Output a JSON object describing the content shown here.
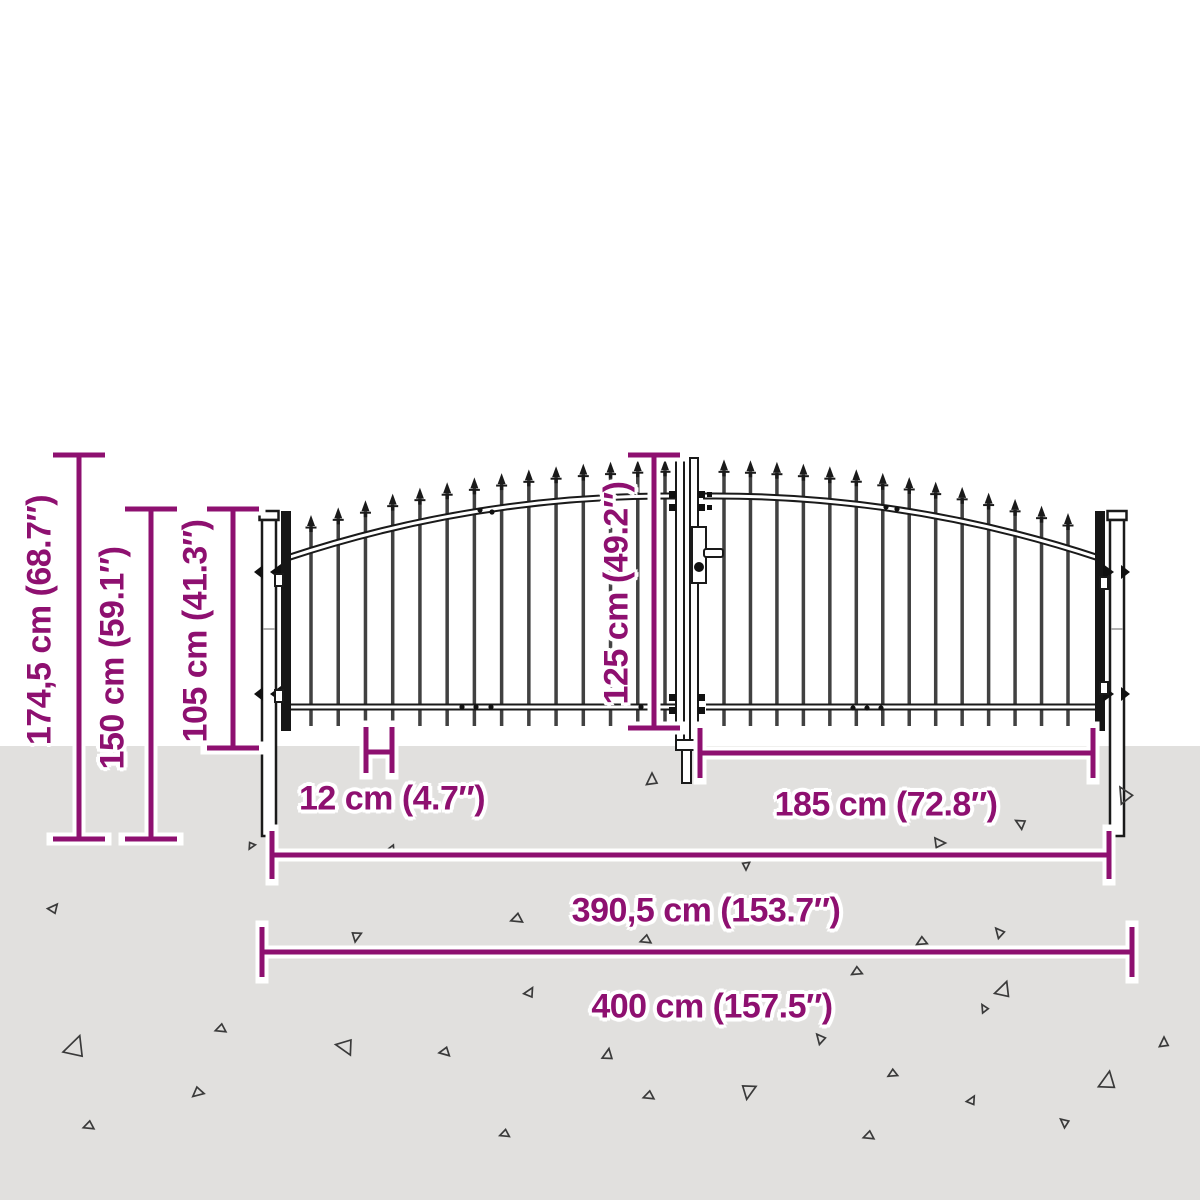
{
  "title": "Double door garden gate with spear top - dimension diagram",
  "colors": {
    "annotation": "#8E1070",
    "halo": "#ffffff",
    "gate": "#1a1a1a",
    "bar": "#414141",
    "ground": "#e1e0de",
    "background": "#ffffff",
    "triangle": "#3a3a3a"
  },
  "labels": {
    "total_height": "174,5 cm (68.7″)",
    "height_150": "150 cm (59.1″)",
    "height_105": "105 cm (41.3″)",
    "height_125": "125 cm (49.2″)",
    "spacing_12": "12 cm (4.7″)",
    "width_185": "185 cm (72.8″)",
    "width_390": "390,5 cm (153.7″)",
    "width_400": "400 cm (157.5″)"
  },
  "geometry": {
    "canvas": {
      "width": 1200,
      "height": 1200
    },
    "ground_top": 746,
    "label_positions": {
      "total_height": {
        "x": 40,
        "y": 620,
        "rotate": true
      },
      "height_150": {
        "x": 113,
        "y": 658,
        "rotate": true
      },
      "height_105": {
        "x": 196,
        "y": 631,
        "rotate": true
      },
      "height_125": {
        "x": 617,
        "y": 593,
        "rotate": true
      },
      "spacing_12": {
        "x": 392,
        "y": 799,
        "rotate": false
      },
      "width_185": {
        "x": 886,
        "y": 805,
        "rotate": false
      },
      "width_390": {
        "x": 706,
        "y": 911,
        "rotate": false
      },
      "width_400": {
        "x": 712,
        "y": 1007,
        "rotate": false
      }
    },
    "dimension_lines": [
      {
        "name": "total-height-line",
        "type": "v",
        "x": 79,
        "y1": 455,
        "y2": 839,
        "cap": 26
      },
      {
        "name": "height-150-line",
        "type": "v",
        "x": 151,
        "y1": 509,
        "y2": 839,
        "cap": 26
      },
      {
        "name": "height-105-line",
        "type": "v",
        "x": 233,
        "y1": 509,
        "y2": 748,
        "cap": 26
      },
      {
        "name": "height-125-line",
        "type": "v",
        "x": 654,
        "y1": 455,
        "y2": 728,
        "cap": 26
      },
      {
        "name": "width-185-line",
        "type": "h",
        "y": 753,
        "x1": 700,
        "x2": 1093,
        "cap": 25
      },
      {
        "name": "width-390-line",
        "type": "h",
        "y": 855,
        "x1": 272,
        "x2": 1109,
        "cap": 24
      },
      {
        "name": "width-400-line",
        "type": "h",
        "y": 952,
        "x1": 262,
        "x2": 1132,
        "cap": 25
      },
      {
        "name": "spacing-12-bracket",
        "type": "bracket",
        "x1": 366,
        "x2": 392,
        "y1": 727,
        "y2": 773,
        "ymid": 752
      }
    ],
    "arch": {
      "cx": 693,
      "half": 405,
      "base": 558,
      "rise": 63,
      "tip_above": 36,
      "bar_bottom": 726
    },
    "bars": {
      "left": {
        "start": 311,
        "end": 665,
        "count": 14
      },
      "right": {
        "start": 724,
        "end": 1068,
        "count": 14
      }
    },
    "triangles": [
      [
        54,
        908,
        10,
        40
      ],
      [
        356,
        937,
        10,
        190
      ],
      [
        746,
        866,
        8,
        180
      ],
      [
        392,
        850,
        8,
        150
      ],
      [
        251,
        846,
        7,
        210
      ],
      [
        652,
        779,
        12,
        0
      ],
      [
        940,
        843,
        11,
        90
      ],
      [
        1020,
        823,
        10,
        300
      ],
      [
        1124,
        794,
        16,
        330
      ],
      [
        516,
        919,
        11,
        250
      ],
      [
        645,
        940,
        10,
        250
      ],
      [
        921,
        942,
        10,
        240
      ],
      [
        999,
        932,
        10,
        320
      ],
      [
        856,
        972,
        10,
        240
      ],
      [
        530,
        992,
        10,
        30
      ],
      [
        1004,
        989,
        16,
        20
      ],
      [
        984,
        1008,
        8,
        330
      ],
      [
        76,
        1046,
        22,
        20
      ],
      [
        220,
        1029,
        10,
        250
      ],
      [
        344,
        1046,
        17,
        280
      ],
      [
        197,
        1093,
        11,
        230
      ],
      [
        88,
        1126,
        10,
        250
      ],
      [
        444,
        1052,
        10,
        260
      ],
      [
        608,
        1054,
        11,
        10
      ],
      [
        648,
        1096,
        10,
        250
      ],
      [
        748,
        1092,
        15,
        190
      ],
      [
        820,
        1038,
        10,
        320
      ],
      [
        892,
        1074,
        9,
        240
      ],
      [
        868,
        1136,
        10,
        250
      ],
      [
        504,
        1134,
        9,
        250
      ],
      [
        972,
        1100,
        9,
        30
      ],
      [
        1064,
        1122,
        9,
        310
      ],
      [
        1108,
        1080,
        18,
        10
      ],
      [
        1164,
        1042,
        10,
        0
      ],
      [
        697,
        1004,
        7,
        40
      ]
    ]
  }
}
